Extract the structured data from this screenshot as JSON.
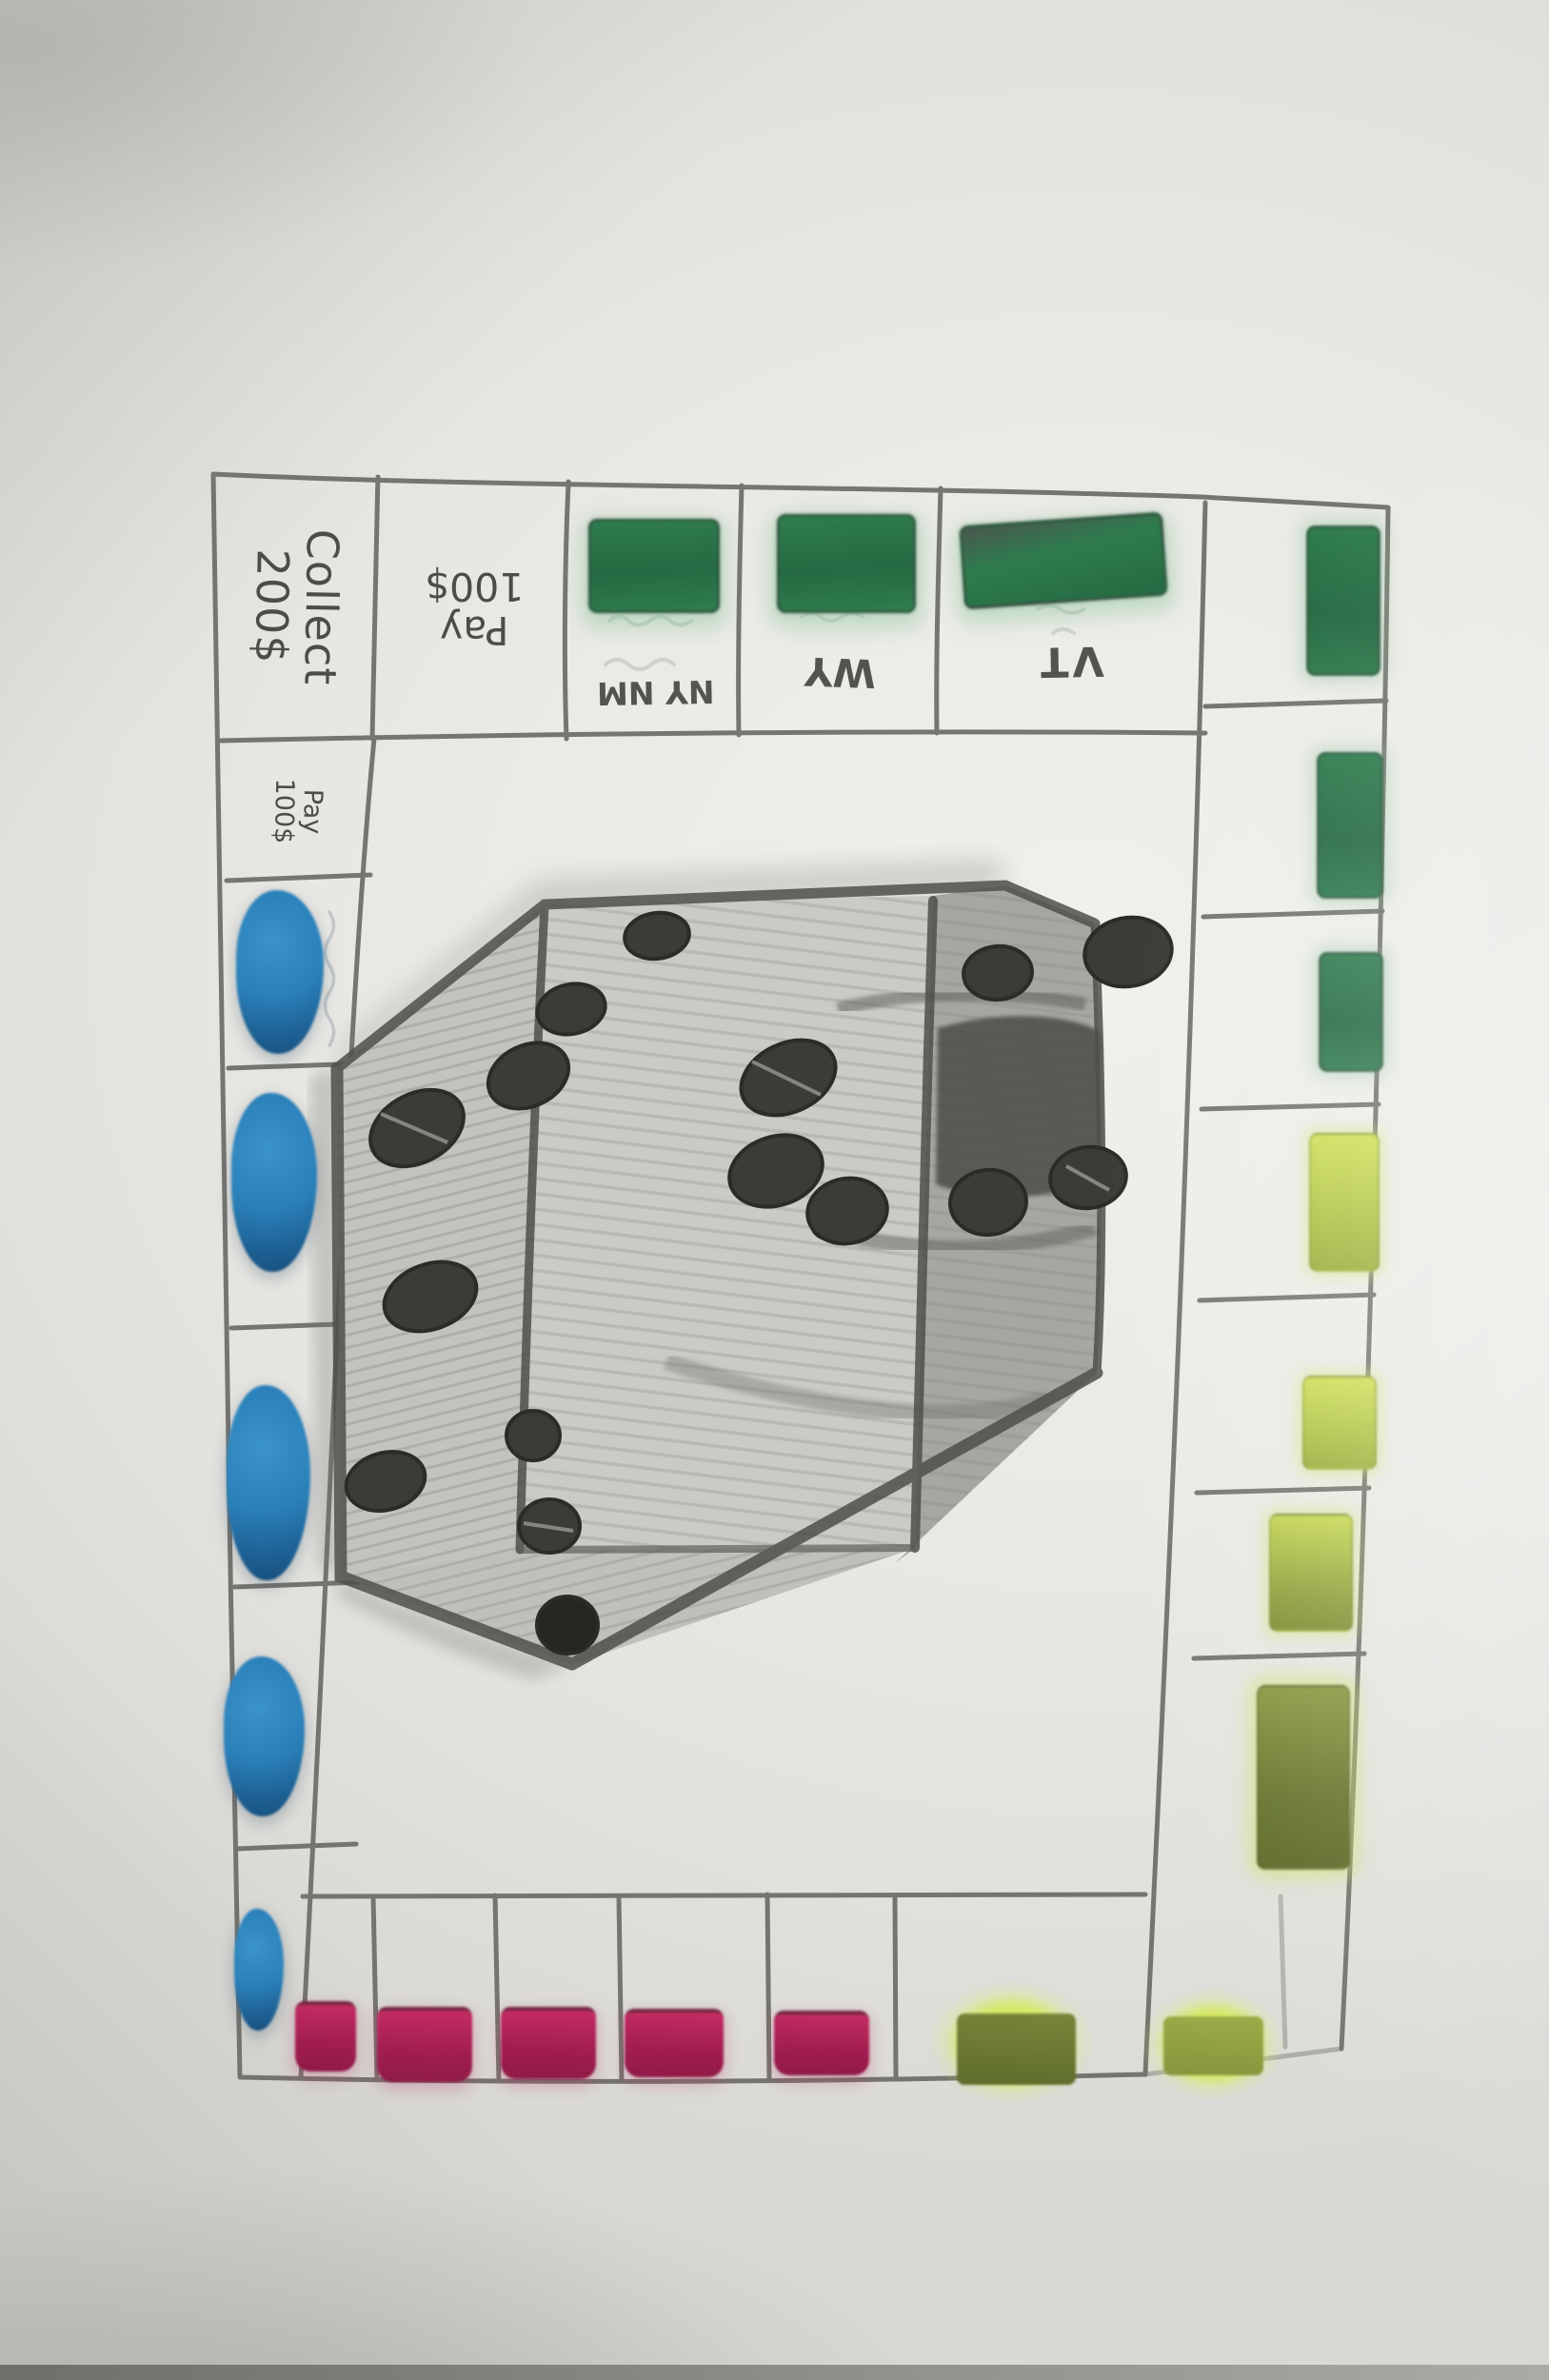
{
  "palette": {
    "paper": "#e9e8e4",
    "pencil_line": "#66655f",
    "green_bar": "#2e7c4e",
    "green_halo": "#b9ddc2",
    "chartreuse_bar": "#c9dc52",
    "olive_bar": "#6e7c33",
    "blue_marker": "#2a7fb8",
    "pink_bar": "#b5245a",
    "graphite": "#8f8e89"
  },
  "board": {
    "top_row": [
      {
        "type": "corner",
        "label": "Collect\n200$"
      },
      {
        "type": "tax",
        "label": "Pay\n100$"
      },
      {
        "type": "property",
        "abbr": "NY NM",
        "color": "green"
      },
      {
        "type": "property",
        "abbr": "WY",
        "color": "green"
      },
      {
        "type": "property",
        "abbr": "VT",
        "color": "green"
      },
      {
        "type": "corner",
        "color": "green"
      }
    ],
    "right_column": [
      {
        "color": "green"
      },
      {
        "color": "green"
      },
      {
        "color": "chartreuse"
      },
      {
        "color": "chartreuse"
      },
      {
        "color": "chartreuse"
      },
      {
        "color": "olive"
      }
    ],
    "bottom_row": [
      {
        "type": "corner",
        "color": "blue"
      },
      {
        "color": "pink"
      },
      {
        "color": "pink"
      },
      {
        "color": "pink"
      },
      {
        "color": "pink"
      },
      {
        "color": "pink"
      },
      {
        "color": "chartreuse-olive"
      },
      {
        "type": "corner",
        "color": "chartreuse-olive"
      }
    ],
    "left_column": [
      {
        "type": "tax",
        "label": "Pay\n100$"
      },
      {
        "color": "blue"
      },
      {
        "color": "blue"
      },
      {
        "color": "blue"
      },
      {
        "color": "blue"
      }
    ],
    "center": {
      "drawing": "graphite pencil sketch of a large tilted die",
      "visible_pips": {
        "left_faces": 8,
        "right_face": 5,
        "bottom_face": 3
      }
    }
  }
}
